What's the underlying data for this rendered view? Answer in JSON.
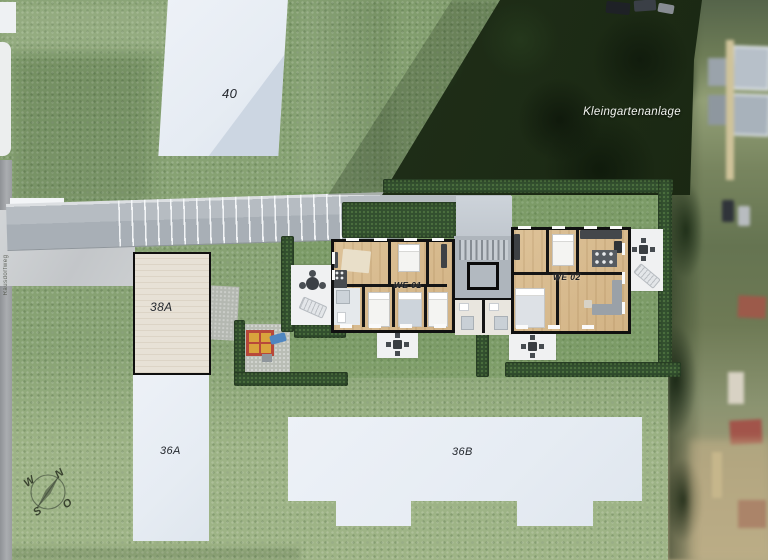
{
  "site": {
    "buildings": {
      "b40": "40",
      "b38a": "38A",
      "b36a": "36A",
      "b36b": "36B"
    },
    "units": {
      "we01": "WE 01",
      "we02": "WE 02"
    },
    "areas": {
      "kleingarten": "Kleingartenanlage",
      "street": "Rausdorfweg"
    },
    "compass": {
      "north": "N",
      "east": "O",
      "south": "S",
      "west": "W"
    },
    "colors": {
      "grass": "#87a273",
      "garden_grass": "#6f9a52",
      "hedge": "#33502f",
      "dark_trees": "#1f2e18",
      "wood_floor": "#d6b98c",
      "wall_black": "#101010",
      "building_white": "#e9eef5",
      "building_38a": "#e7e1d6",
      "ramp_gray": "#b0b7be",
      "patio_white": "#f0f1f2",
      "playground_red": "#b8483a",
      "playground_sand": "#d9a33c",
      "slide_blue": "#4f86c0"
    }
  }
}
